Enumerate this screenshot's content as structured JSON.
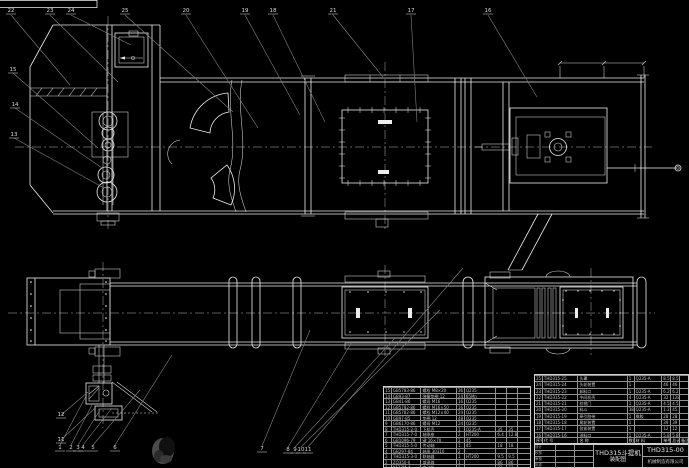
{
  "colors": {
    "background": "#000000",
    "line": "#ededed",
    "leader": "#828282",
    "table_line": "#8f8f8f",
    "text": "#c6c6c6"
  },
  "title_block": {
    "product": "THD315斗提机",
    "subtitle": "装配图",
    "drawing_no": "THD315-00",
    "company": "机械制造有限公司",
    "sign_labels": [
      "设计",
      "校核",
      "审核",
      "批准"
    ]
  },
  "bom_right": {
    "header": [
      [
        "序号",
        "代  号",
        "名  称",
        "数量",
        "材  料",
        "单件",
        "总计",
        "备注"
      ]
    ],
    "rows": [
      [
        "25",
        "THD315-25",
        "头罩",
        "1",
        "Q235-A",
        "8.5",
        "8.5",
        ""
      ],
      [
        "24",
        "THD315-24",
        "头轮装置",
        "1",
        "",
        "46",
        "46",
        ""
      ],
      [
        "23",
        "THD315-23",
        "卸料口",
        "1",
        "Q235-A",
        "6.2",
        "6.2",
        ""
      ],
      [
        "22",
        "THD315-22",
        "中间机壳",
        "4",
        "Q235-A",
        "32",
        "128",
        ""
      ],
      [
        "21",
        "THD315-21",
        "检视门",
        "1",
        "Q235-A",
        "4.5",
        "4.5",
        ""
      ],
      [
        "20",
        "THD315-20",
        "料斗",
        "38",
        "Q235-A",
        "1.2",
        "45.6",
        ""
      ],
      [
        "19",
        "THD315-19",
        "牵引胶带",
        "1",
        "橡胶",
        "28",
        "28",
        ""
      ],
      [
        "18",
        "THD315-18",
        "尾轮装置",
        "1",
        "",
        "39",
        "39",
        ""
      ],
      [
        "17",
        "THD315-17",
        "张紧装置",
        "1",
        "",
        "12",
        "12",
        ""
      ],
      [
        "16",
        "THD315-16",
        "进料口",
        "1",
        "Q235-A",
        "5.8",
        "5.8",
        ""
      ]
    ]
  },
  "bom_left": {
    "rows": [
      [
        "15",
        "GB5783-86",
        "螺栓 M8×20",
        "36",
        "Q235",
        "",
        "",
        ""
      ],
      [
        "14",
        "GB93-87",
        "弹簧垫圈 12",
        "24",
        "65Mn",
        "",
        "",
        ""
      ],
      [
        "13",
        "GB41-86",
        "螺母 M16",
        "16",
        "Q235",
        "",
        "",
        ""
      ],
      [
        "12",
        "GB5782-86",
        "螺栓 M16×50",
        "16",
        "Q235",
        "",
        "",
        ""
      ],
      [
        "11",
        "GB5782-86",
        "螺栓 M12×40",
        "24",
        "Q235",
        "",
        "",
        ""
      ],
      [
        "10",
        "GB97-85",
        "垫圈 12",
        "48",
        "Q235",
        "",
        "",
        ""
      ],
      [
        "9",
        "GB6170-86",
        "螺母 M12",
        "24",
        "Q235",
        "",
        "",
        ""
      ],
      [
        "8",
        "THD315-2-0",
        "下机壳",
        "1",
        "Q235-A",
        "35",
        "35",
        ""
      ],
      [
        "7",
        "THD315-7-0",
        "轴承座",
        "2",
        "HT200",
        "6.4",
        "12.8",
        ""
      ],
      [
        "6",
        "GB1096-79",
        "键 16×70",
        "2",
        "45",
        "",
        "",
        ""
      ],
      [
        "5",
        "THD315-5-0",
        "传动轴",
        "1",
        "45",
        "18",
        "18",
        ""
      ],
      [
        "4",
        "GB297-84",
        "轴承 30310",
        "2",
        "",
        "",
        "",
        ""
      ],
      [
        "3",
        "THD315-3-0",
        "联轴器",
        "1",
        "HT200",
        "9.5",
        "9.5",
        ""
      ],
      [
        "2",
        "ZQ350-Ⅱ",
        "减速器",
        "1",
        "",
        "86",
        "86",
        ""
      ],
      [
        "1",
        "Y132M-4",
        "电动机",
        "1",
        "",
        "73",
        "73",
        ""
      ]
    ]
  },
  "callouts": [
    {
      "n": "22",
      "x": 8,
      "y": 9
    },
    {
      "n": "23",
      "x": 47,
      "y": 9
    },
    {
      "n": "24",
      "x": 68,
      "y": 9
    },
    {
      "n": "25",
      "x": 122,
      "y": 9
    },
    {
      "n": "20",
      "x": 183,
      "y": 9
    },
    {
      "n": "19",
      "x": 242,
      "y": 9
    },
    {
      "n": "18",
      "x": 270,
      "y": 9
    },
    {
      "n": "21",
      "x": 330,
      "y": 9
    },
    {
      "n": "17",
      "x": 408,
      "y": 9
    },
    {
      "n": "16",
      "x": 485,
      "y": 9
    },
    {
      "n": "15",
      "x": 10,
      "y": 68
    },
    {
      "n": "14",
      "x": 12,
      "y": 103
    },
    {
      "n": "13",
      "x": 11,
      "y": 133
    },
    {
      "n": "12",
      "x": 58,
      "y": 413
    },
    {
      "n": "11",
      "x": 58,
      "y": 438
    },
    {
      "n": "1",
      "x": 57,
      "y": 446
    },
    {
      "n": "2",
      "x": 68,
      "y": 446
    },
    {
      "n": "3",
      "x": 75,
      "y": 446
    },
    {
      "n": "4",
      "x": 80,
      "y": 446
    },
    {
      "n": "5",
      "x": 90,
      "y": 446
    },
    {
      "n": "6",
      "x": 112,
      "y": 446
    },
    {
      "n": "7",
      "x": 259,
      "y": 447
    },
    {
      "n": "8",
      "x": 285,
      "y": 448
    },
    {
      "n": "9",
      "x": 292,
      "y": 448
    },
    {
      "n": "10",
      "x": 298,
      "y": 448
    },
    {
      "n": "11",
      "x": 305,
      "y": 448
    }
  ]
}
